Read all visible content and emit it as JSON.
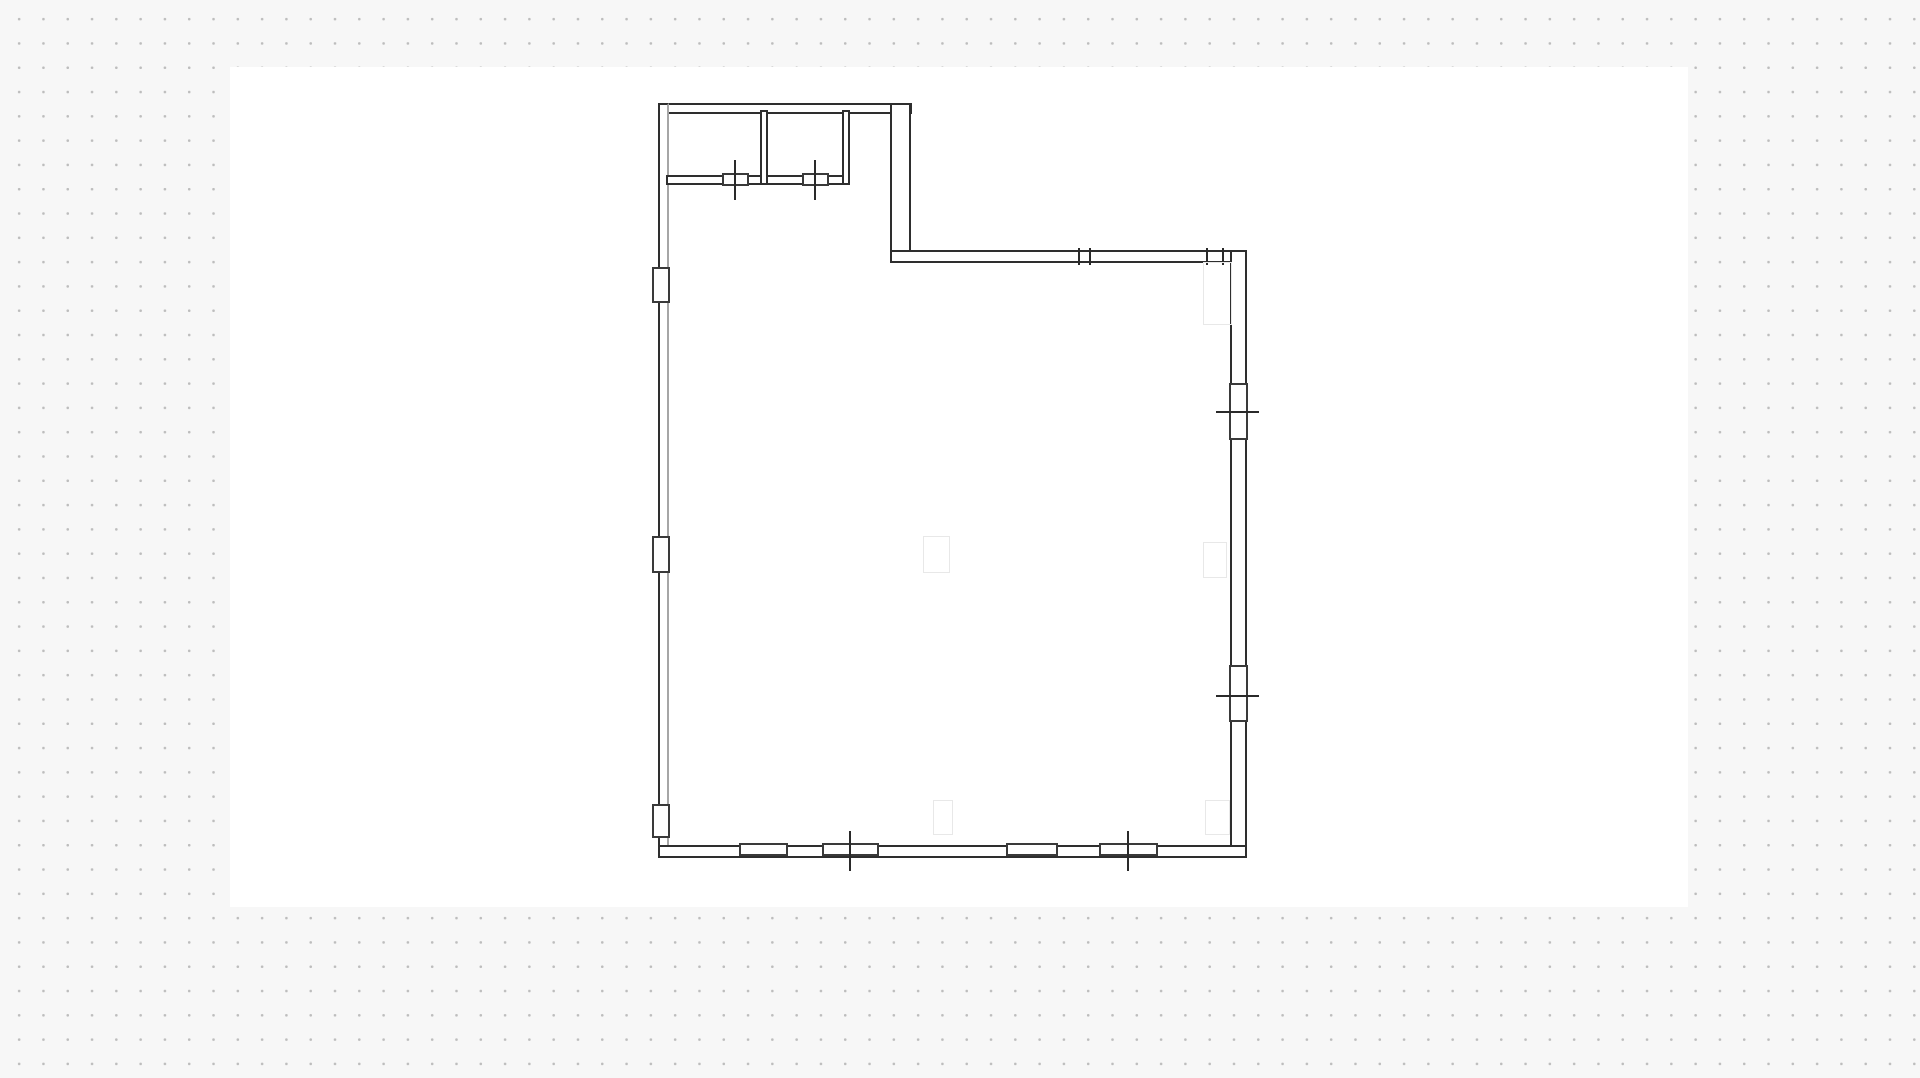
{
  "canvas": {
    "background_color": "#f7f7f7",
    "dot_color": "#bdbdbd",
    "dot_spacing_px": 24.3,
    "dot_offset_px": 7,
    "artboard": {
      "x": 230,
      "y": 67,
      "width": 1458,
      "height": 840,
      "color": "#ffffff"
    }
  },
  "floor_plan": {
    "colors": {
      "wall_stroke": "#2e2e2e",
      "wall_stroke_dark": "#3a3a3a",
      "wall_stroke_light": "#a6a6a6",
      "tick": "#2a2a2a",
      "placeholder_stroke": "#e8e8e8",
      "wall_fill": "#ffffff"
    },
    "walls": [
      {
        "name": "wall-top-upper-section",
        "x": 658,
        "y": 103,
        "w": 254,
        "h": 11
      },
      {
        "name": "wall-left",
        "x": 658,
        "y": 103,
        "w": 11,
        "h": 755,
        "light_inner": true
      },
      {
        "name": "wall-step-right-of-upper",
        "x": 890,
        "y": 103,
        "w": 21,
        "h": 160
      },
      {
        "name": "wall-top-main",
        "x": 890,
        "y": 250,
        "w": 357,
        "h": 13
      },
      {
        "name": "wall-right",
        "x": 1230,
        "y": 250,
        "w": 17,
        "h": 608
      },
      {
        "name": "wall-bottom",
        "x": 658,
        "y": 845,
        "w": 589,
        "h": 13
      },
      {
        "name": "wall-storage-bottom",
        "x": 666,
        "y": 175,
        "w": 184,
        "h": 10
      },
      {
        "name": "wall-storage-divider",
        "x": 760,
        "y": 110,
        "w": 8,
        "h": 75
      },
      {
        "name": "wall-storage-right",
        "x": 842,
        "y": 110,
        "w": 8,
        "h": 75
      }
    ],
    "openings": [
      {
        "name": "window-left-1",
        "x": 652,
        "y": 267,
        "w": 18,
        "h": 36
      },
      {
        "name": "window-left-2",
        "x": 652,
        "y": 536,
        "w": 18,
        "h": 37
      },
      {
        "name": "window-left-3",
        "x": 652,
        "y": 804,
        "w": 18,
        "h": 34
      },
      {
        "name": "door-storage-1",
        "x": 722,
        "y": 173,
        "w": 27,
        "h": 13
      },
      {
        "name": "door-storage-2",
        "x": 802,
        "y": 173,
        "w": 27,
        "h": 13
      },
      {
        "name": "window-bottom-1",
        "x": 739,
        "y": 843,
        "w": 49,
        "h": 13
      },
      {
        "name": "door-bottom-1",
        "x": 822,
        "y": 843,
        "w": 57,
        "h": 13
      },
      {
        "name": "window-bottom-2",
        "x": 1006,
        "y": 843,
        "w": 52,
        "h": 13
      },
      {
        "name": "door-bottom-2",
        "x": 1099,
        "y": 843,
        "w": 59,
        "h": 13
      },
      {
        "name": "window-right-1",
        "x": 1229,
        "y": 383,
        "w": 19,
        "h": 57
      },
      {
        "name": "window-right-2",
        "x": 1229,
        "y": 665,
        "w": 19,
        "h": 57
      }
    ],
    "ticks": [
      {
        "name": "door-tick-storage-1",
        "x": 734,
        "y": 160,
        "w": 2,
        "h": 40
      },
      {
        "name": "door-tick-storage-2",
        "x": 814,
        "y": 160,
        "w": 2,
        "h": 40
      },
      {
        "name": "door-tick-bottom-1",
        "x": 849,
        "y": 831,
        "w": 2,
        "h": 40
      },
      {
        "name": "door-tick-bottom-2",
        "x": 1127,
        "y": 831,
        "w": 2,
        "h": 40
      },
      {
        "name": "window-tick-right-1",
        "x": 1216,
        "y": 411,
        "w": 43,
        "h": 2
      },
      {
        "name": "window-tick-right-2",
        "x": 1216,
        "y": 695,
        "w": 43,
        "h": 2
      },
      {
        "name": "joint-tick-top-1",
        "x": 1078,
        "y": 248,
        "w": 2,
        "h": 17
      },
      {
        "name": "joint-tick-top-2",
        "x": 1089,
        "y": 248,
        "w": 2,
        "h": 17
      },
      {
        "name": "joint-tick-top-3",
        "x": 1206,
        "y": 248,
        "w": 2,
        "h": 17
      },
      {
        "name": "joint-tick-top-4",
        "x": 1222,
        "y": 248,
        "w": 2,
        "h": 17
      }
    ],
    "placeholders": [
      {
        "name": "placeholder-center",
        "x": 923,
        "y": 536,
        "w": 27,
        "h": 37
      },
      {
        "name": "placeholder-right-top",
        "x": 1203,
        "y": 262,
        "w": 29,
        "h": 63
      },
      {
        "name": "placeholder-right-middle",
        "x": 1203,
        "y": 542,
        "w": 24,
        "h": 36
      },
      {
        "name": "placeholder-right-bottom",
        "x": 1205,
        "y": 800,
        "w": 25,
        "h": 35
      },
      {
        "name": "placeholder-bottom-center",
        "x": 933,
        "y": 800,
        "w": 20,
        "h": 35
      }
    ]
  }
}
